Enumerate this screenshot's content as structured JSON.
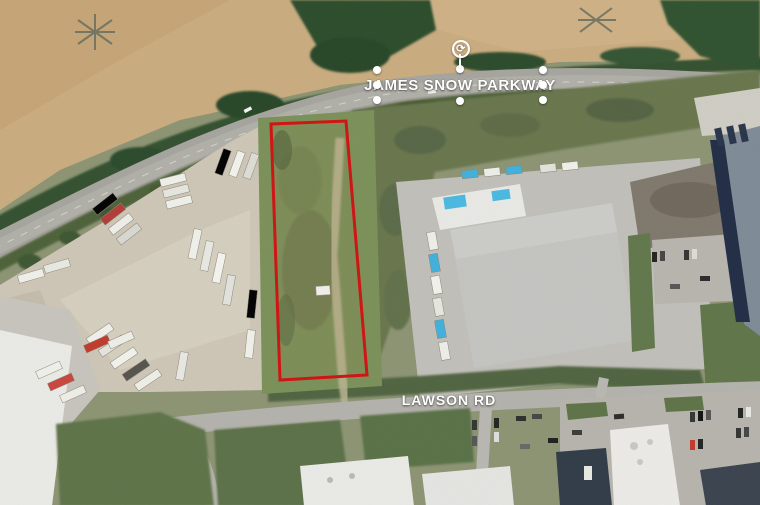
{
  "map": {
    "kind": "satellite-aerial-photo",
    "labels": {
      "james_snow_parkway": "JAMES SNOW PARKWAY",
      "lawson_rd": "LAWSON RD"
    },
    "parcel": {
      "description": "vacant green lot outlined in red between truck yard and warehouse",
      "outline_color": "#cf1110",
      "points": "271,124 346,121 367,375 280,380"
    },
    "selection": {
      "selected_label": "JAMES SNOW PARKWAY",
      "handle_count": 8,
      "handle_color": "#ffffff",
      "rotate_glyph": "⟳"
    },
    "colors": {
      "farm_field": "#c9ab7e",
      "treeline": "#2e4f2e",
      "road_asphalt": "#a5a39d",
      "truck_yard_gravel": "#cdc5b5",
      "parcel_grass": "#7a8f58",
      "warehouse_roof": "#c3c3c0",
      "blue_trailer": "#3fb0dc",
      "navy_roof": "#202c44",
      "label_text": "#ffffff"
    }
  }
}
